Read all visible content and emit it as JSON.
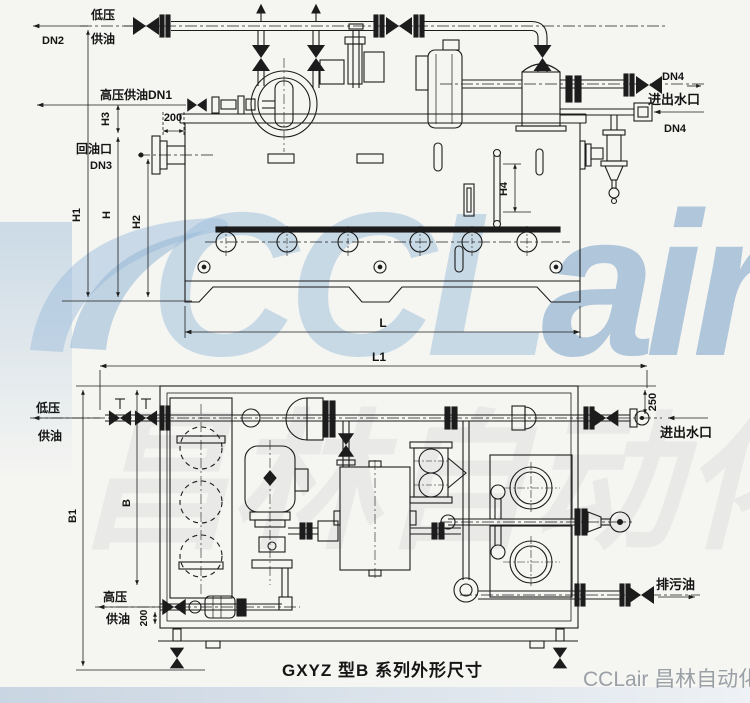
{
  "watermark": {
    "logo_c": "CCL",
    "logo_air": "air",
    "faint": "昌林自动化",
    "brand": "CCLair 昌林自动化",
    "blue": "#a3c1dd",
    "deep_blue": "#769ec7",
    "brand_gray": "#9aa0a6"
  },
  "caption": {
    "text": "GXYZ 型B 系列外形尺寸"
  },
  "front_view": {
    "labels": {
      "low_pressure": "低压",
      "supply_oil": "供油",
      "dn2": "DN2",
      "hp_supply_dn1": "高压供油DN1",
      "h3": "H3",
      "dim_200": "200",
      "return_port": "回油口",
      "dn3": "DN3",
      "h1": "H1",
      "h": "H",
      "h2": "H2",
      "h4": "H4",
      "l": "L",
      "dn4_out": "DN4",
      "water_inout": "进出水口",
      "dn4_in": "DN4"
    }
  },
  "plan_view": {
    "labels": {
      "l1": "L1",
      "dim_250": "250",
      "low_pressure": "低压",
      "supply_oil": "供油",
      "water_inout": "进出水口",
      "b1": "B1",
      "b": "B",
      "hp": "高压",
      "hp_supply_oil": "供油",
      "dim_200": "200",
      "drain": "排污油"
    }
  },
  "colors": {
    "line": "#1c1c1c",
    "background": "#f5f5f2",
    "bottom_band": "#d3dce6"
  }
}
